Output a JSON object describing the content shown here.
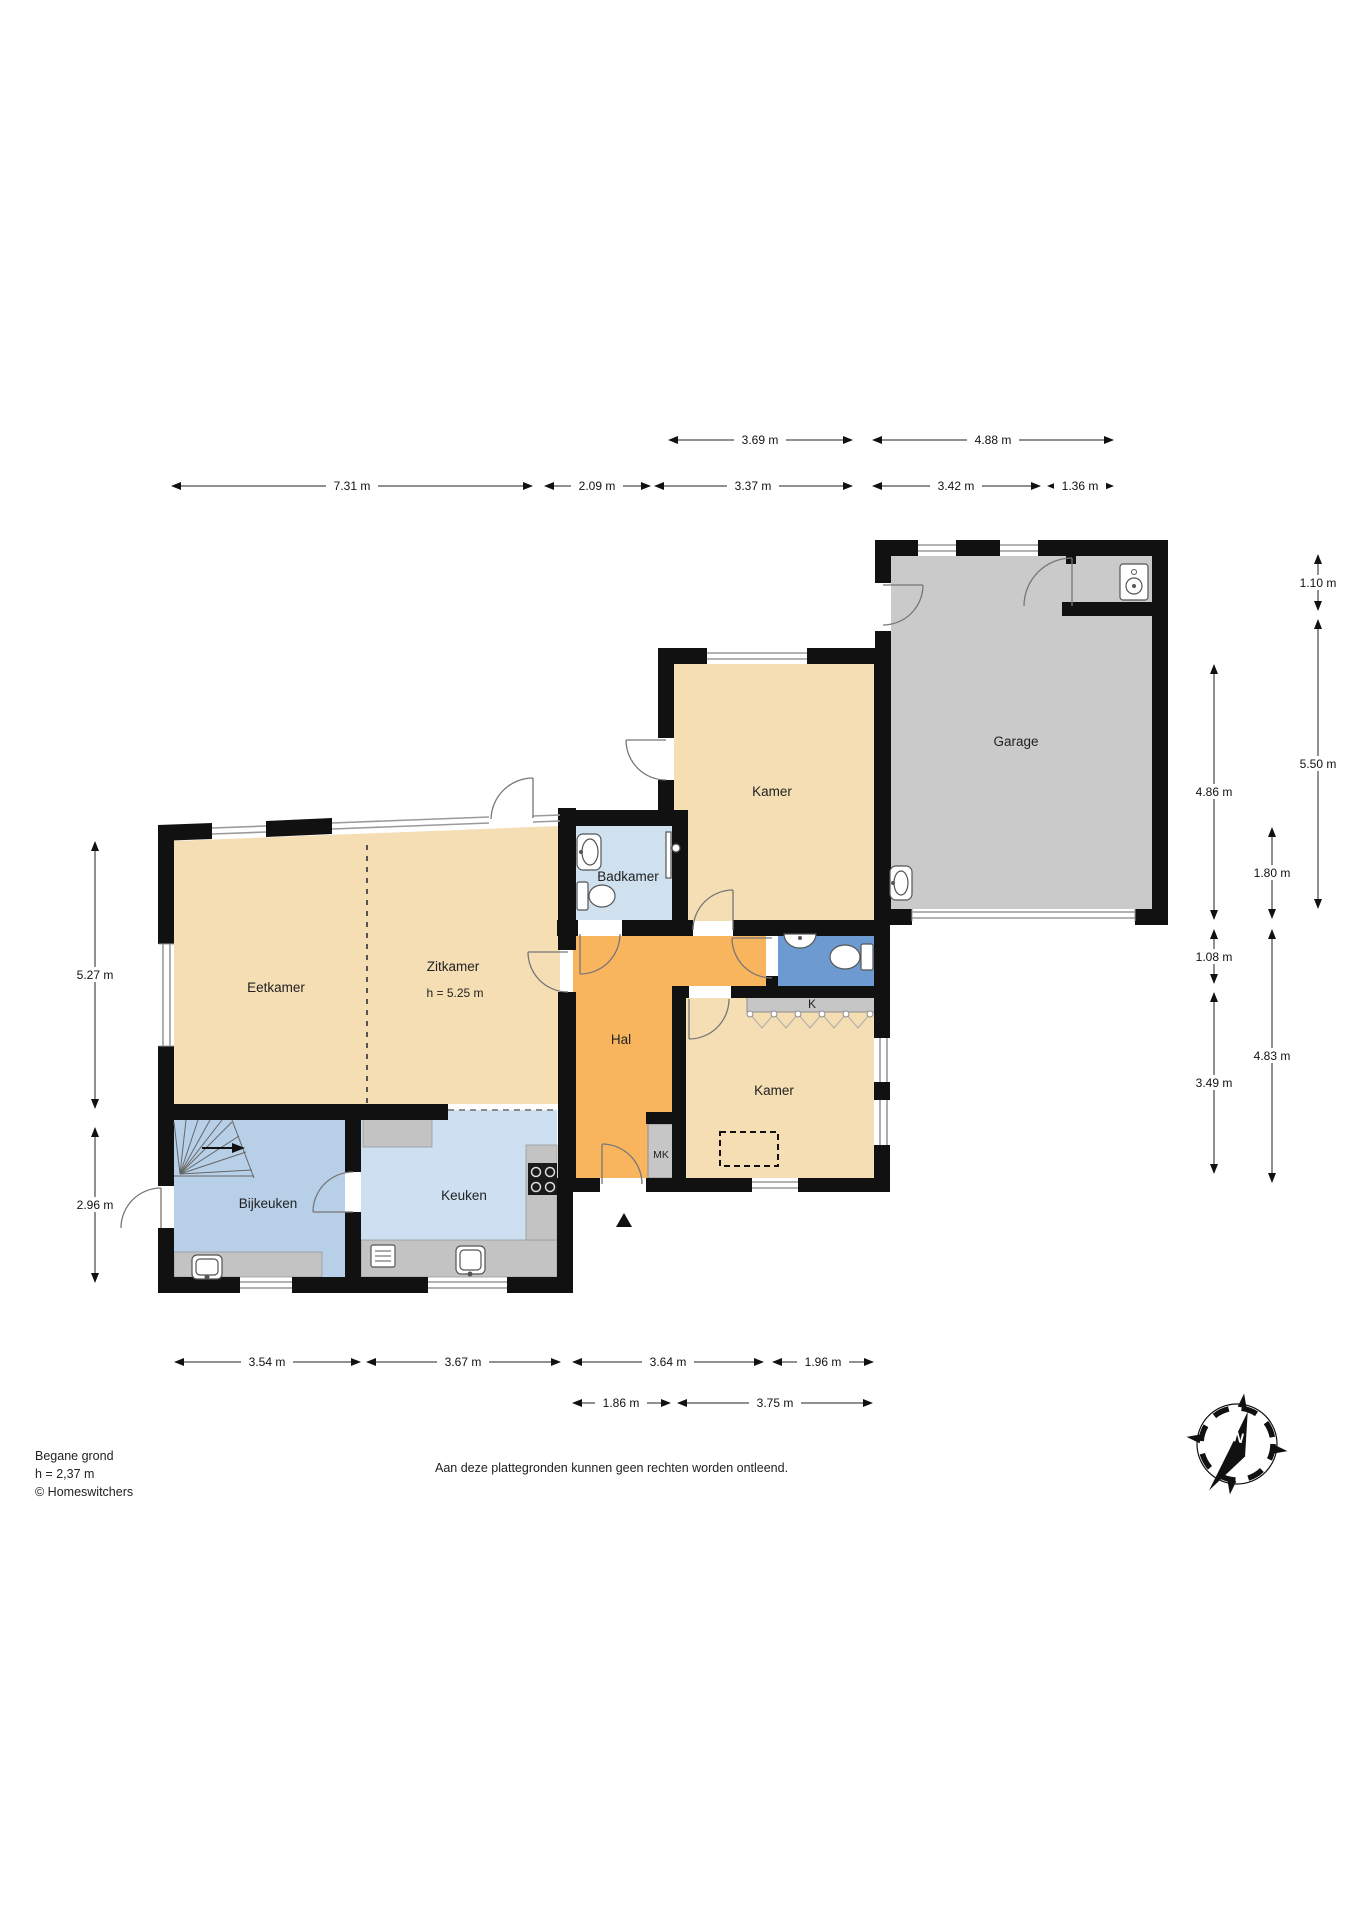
{
  "colors": {
    "wall": "#111111",
    "beige": "#f5ddb4",
    "orange": "#f8b55e",
    "light_blue": "#cfe0ef",
    "mid_blue": "#b7d0e8",
    "kitchen_blue": "#cde0f2",
    "dark_blue": "#6d9ad1",
    "garage_gray": "#cacaca",
    "counter_gray": "#c6c6c6"
  },
  "rooms": {
    "eetkamer": "Eetkamer",
    "zitkamer": "Zitkamer",
    "zitkamer_height": "h = 5.25 m",
    "badkamer": "Badkamer",
    "hal": "Hal",
    "kamer_top": "Kamer",
    "kamer_bottom": "Kamer",
    "keuken": "Keuken",
    "bijkeuken": "Bijkeuken",
    "garage": "Garage",
    "k_closet": "K",
    "mk_closet": "MK"
  },
  "dimensions": {
    "top_row1": [
      "3.69 m",
      "4.88 m"
    ],
    "top_row2": [
      "7.31 m",
      "2.09 m",
      "3.37 m",
      "3.42 m",
      "1.36 m"
    ],
    "bottom_row1": [
      "3.54 m",
      "3.67 m",
      "3.64 m",
      "1.96 m"
    ],
    "bottom_row2": [
      "1.86 m",
      "3.75 m"
    ],
    "left": [
      "5.27 m",
      "2.96 m"
    ],
    "right": [
      "1.10 m",
      "5.50 m",
      "4.86 m",
      "1.80 m",
      "1.08 m",
      "4.83 m",
      "3.49 m"
    ]
  },
  "footer": {
    "floor_label": "Begane grond",
    "floor_height": "h = 2,37 m",
    "copyright": "© Homeswitchers",
    "disclaimer": "Aan deze plattegronden kunnen geen rechten worden ontleend."
  },
  "compass": {
    "north": "N"
  }
}
